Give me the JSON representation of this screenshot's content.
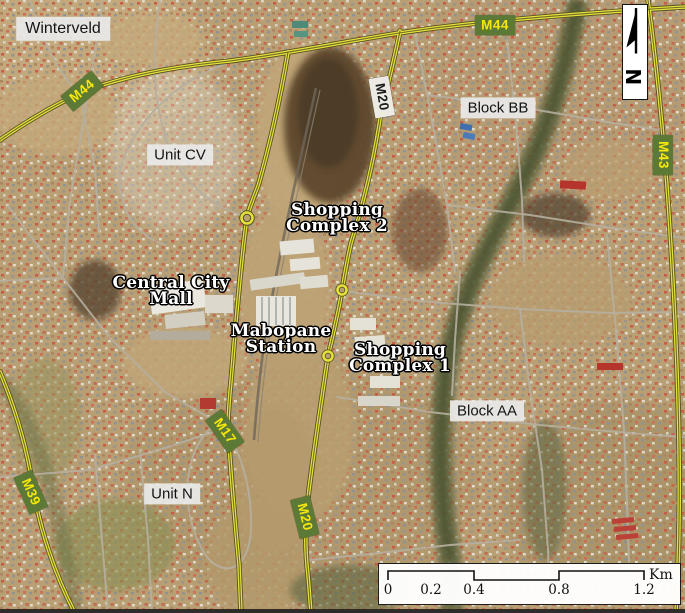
{
  "map": {
    "region_labels": [
      {
        "text": "Winterveld"
      },
      {
        "text": "Unit CV"
      },
      {
        "text": "Block BB"
      },
      {
        "text": "Block AA"
      },
      {
        "text": "Unit N"
      }
    ],
    "place_labels": [
      {
        "line1": "Shopping",
        "line2": "Complex 2"
      },
      {
        "line1": "Central City",
        "line2": "Mall"
      },
      {
        "line1": "Mabopane",
        "line2": "Station"
      },
      {
        "line1": "Shopping",
        "line2": "Complex 1"
      }
    ],
    "road_shields": [
      {
        "text": "M44"
      },
      {
        "text": "M44"
      },
      {
        "text": "M43"
      },
      {
        "text": "M20"
      },
      {
        "text": "M17"
      },
      {
        "text": "M39"
      },
      {
        "text": "M20"
      }
    ],
    "north_arrow_label": "N",
    "scale_bar": {
      "ticks": [
        "0",
        "0.2",
        "0.4",
        "0.8",
        "1.2"
      ],
      "unit": "Km"
    },
    "colors": {
      "major_road": "#e6e03c",
      "shield_green": "#5c7a36",
      "shield_text": "#f7e70a",
      "label_box_bg": "#eaeae8"
    }
  }
}
